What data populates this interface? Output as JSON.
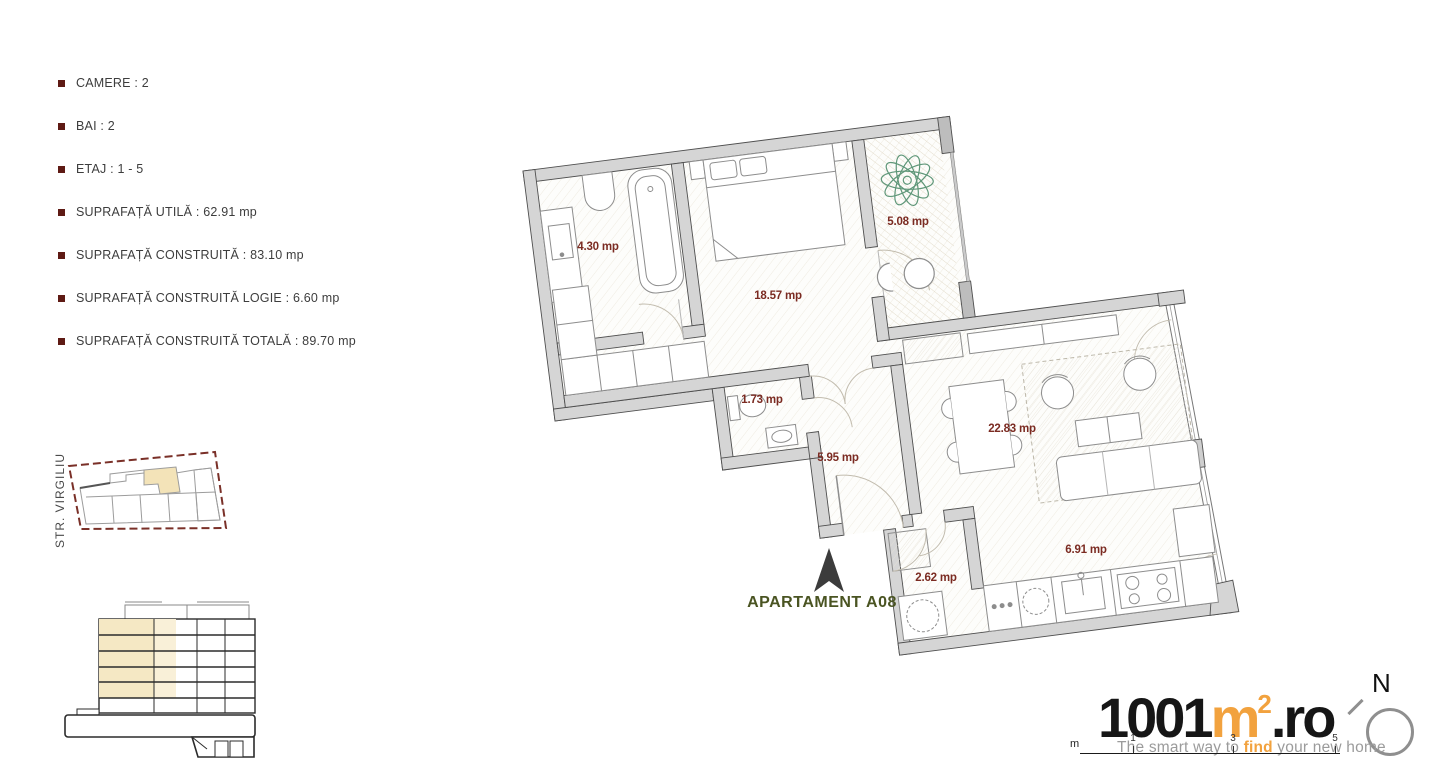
{
  "specs": {
    "items": [
      "CAMERE : 2",
      "BAI : 2",
      "ETAJ : 1 - 5",
      "SUPRAFAȚĂ UTILĂ : 62.91 mp",
      "SUPRAFAȚĂ CONSTRUITĂ : 83.10 mp",
      "SUPRAFAȚĂ CONSTRUITĂ LOGIE : 6.60 mp",
      "SUPRAFAȚĂ CONSTRUITĂ TOTALĂ : 89.70 mp"
    ],
    "bullet_color": "#5E1A14"
  },
  "site_plan": {
    "street_label": "STR. VIRGILIU",
    "boundary_color": "#7A3028",
    "highlight_color": "#F3E3B8"
  },
  "section": {
    "highlight_color": "#F5E8C4"
  },
  "plan": {
    "title": "APARTAMENT A08",
    "title_color": "#4A5422",
    "area_label_color": "#7B2B22",
    "rooms": [
      {
        "name": "baie-principala",
        "area": "4.30 mp"
      },
      {
        "name": "dormitor",
        "area": "18.57 mp"
      },
      {
        "name": "logie",
        "area": "5.08 mp"
      },
      {
        "name": "debara",
        "area": "1.73 mp"
      },
      {
        "name": "hol",
        "area": "5.95 mp"
      },
      {
        "name": "living",
        "area": "22.83 mp"
      },
      {
        "name": "baie-secundara",
        "area": "2.62 mp"
      },
      {
        "name": "bucatarie",
        "area": "6.91 mp"
      }
    ]
  },
  "branding": {
    "logo_digits": "1001",
    "logo_m": "m",
    "logo_exponent": "2",
    "logo_tld": ".ro",
    "logo_orange": "#F2A23E",
    "logo_black": "#161616",
    "tagline_pre": "The smart way to ",
    "tagline_highlight": "find",
    "tagline_post": " your new home",
    "north_letter": "N"
  },
  "scale_bar": {
    "unit": "m",
    "marks": [
      "1",
      "3",
      "5"
    ]
  }
}
